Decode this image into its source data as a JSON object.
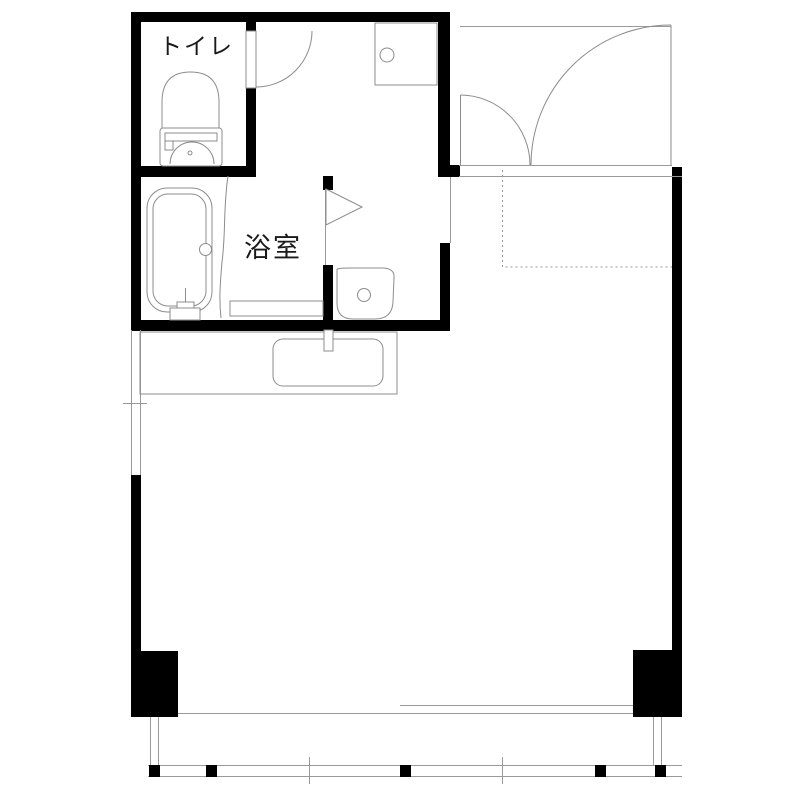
{
  "labels": {
    "toilet": "トイレ",
    "bathroom": "浴室"
  },
  "colors": {
    "wall": "#000000",
    "line": "#9a9a9a",
    "fixture": "#8c8c8c",
    "dotted": "#999999",
    "text": "#1a1a1a",
    "background": "#ffffff"
  }
}
